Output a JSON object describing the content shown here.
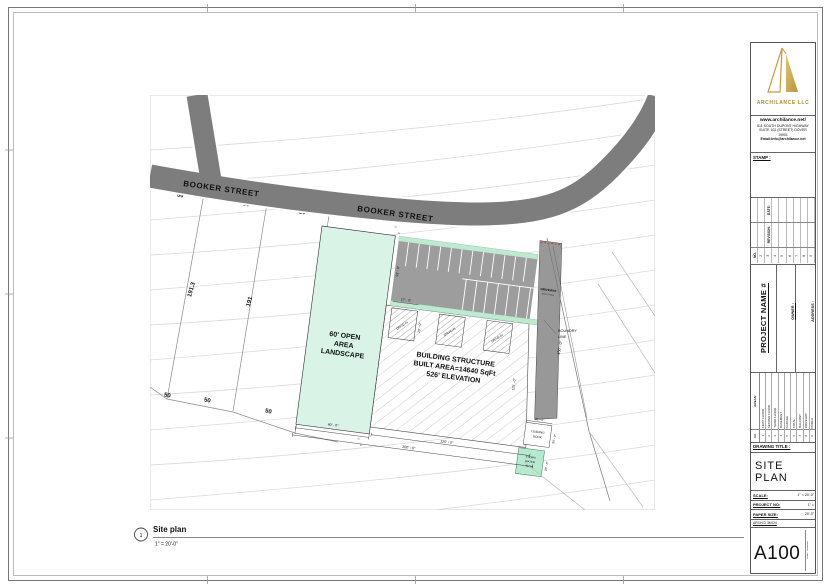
{
  "company": {
    "name": "ARCHILANCE LLC",
    "website": "www.archilance.net/",
    "address1": "611 SOUTH DUPONT HIGHWAY",
    "address2": "SUITE 102 (STREET) DOVER",
    "address3": "19901",
    "email": "Email:Info@archilance.net",
    "stamp_label": "STAMP :"
  },
  "revisions": {
    "date_label": "DATE:",
    "revision_label": "REVISION:",
    "no_label": "NO.",
    "numbers": [
      "1",
      "2",
      "3",
      "4",
      "5",
      "6",
      "7",
      "8",
      "9"
    ]
  },
  "project": {
    "name": "PROJECT NAME #",
    "owner_label": "OWNER :",
    "address_label": "ADDRESS :"
  },
  "areas": {
    "title": "AREAS:",
    "no_label": "NO.",
    "numbers": [
      "1",
      "2",
      "3",
      "4",
      "5",
      "6",
      "7",
      "8",
      "9"
    ],
    "items": [
      "FIRST FLOOR",
      "SECOND FLOOR",
      "THIRD FLOOR",
      "BASEMENT",
      "GARAGE",
      "TOTAL",
      "BALCONY",
      "DRIVEWAY",
      "PORCH"
    ]
  },
  "titleblock": {
    "drawing_title_label": "DRAWING TITLE :",
    "drawing_title": "SITE PLAN",
    "scale_label": "SCALE:",
    "scale_value": "1\" = 20'-0\"",
    "project_no_label": "PROJECT NO:",
    "project_no_value": "1\" =",
    "paper_size_label": "PAPER SIZE:",
    "paper_size_value": "20'-0\"",
    "paper_size_name": "ARCH D 36X24",
    "sheet_number": "A100",
    "sheet_side_text": "SHEET NUMBER"
  },
  "viewtitle": {
    "number": "1",
    "title": "Site plan",
    "scale": "1\" = 20'-0\""
  },
  "plan": {
    "street": "BOOKER STREET",
    "landscape": [
      "60' OPEN",
      "AREA",
      "LANDSCAPE"
    ],
    "building": [
      "BUILDING STRUCTURE",
      "BUILT AREA=14640 SqFt",
      "526' ELEVATION"
    ],
    "driveway": "DRIVEWAY",
    "driveway_sub": "ASPH. PAVING",
    "drive_in": "DRIVE-IN",
    "boundary": [
      "BOUNDRY",
      "LINE"
    ],
    "loading_dock": [
      "LOADING",
      "DOCK"
    ],
    "storm": [
      "STORM",
      "WATER",
      "AREA"
    ],
    "dims": {
      "d5": "5'",
      "d17": "17' - 0\"",
      "d20": "20' - 0\"",
      "d30": "30' - 0\"",
      "d60": "60' - 0\"",
      "d93": "93' - 0\"",
      "d120": "120' - 0\"",
      "d125": "125' - 0\"",
      "d150": "150' - 0\"",
      "d200": "200' - 0\""
    },
    "parcels": {
      "p1": "191.3",
      "p2": "191",
      "p50": "50"
    }
  },
  "colors": {
    "accent_gold": "#b08c3a",
    "road_gray": "#7d7d7d",
    "parking_gray": "#9d9d9d",
    "landscape_green": "#d9f3e6",
    "storm_green": "#b7e9cf"
  }
}
